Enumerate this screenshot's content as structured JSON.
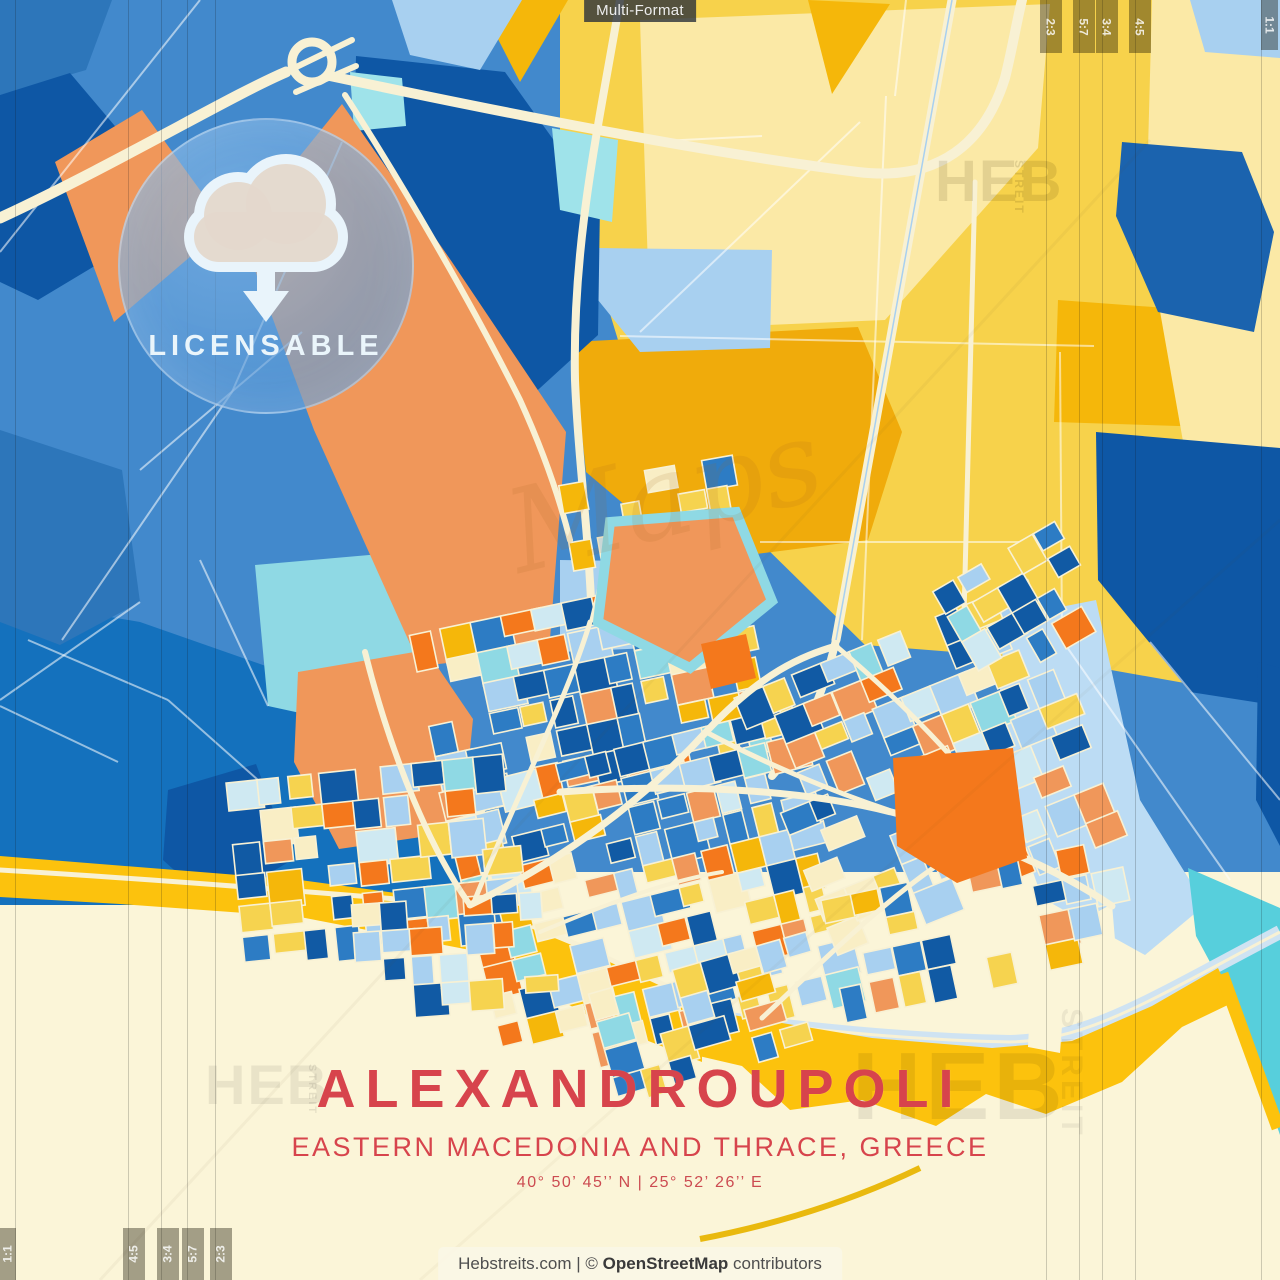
{
  "window": {
    "format_badge": "Multi-Format"
  },
  "license_badge": {
    "label": "LICENSABLE"
  },
  "title_block": {
    "city": "ALEXANDROUPOLI",
    "region": "EASTERN MACEDONIA AND THRACE, GREECE",
    "coordinates": "40°  50’  45’’ N   |   25°  52’  26’’ E"
  },
  "footer": {
    "site": "Hebstreits.com",
    "divider": " | ",
    "copyright": "© ",
    "source": "OpenStreetMap",
    "suffix": " contributors"
  },
  "crop_marks": {
    "top_right": [
      "2:3",
      "5:7",
      "3:4",
      "4:5",
      "1:1"
    ],
    "bottom_left": [
      "1:1",
      "4:5",
      "3:4",
      "5:7",
      "2:3"
    ]
  },
  "watermarks": {
    "brand": "HEB",
    "brand_side": "STREIT",
    "script": "Maps"
  },
  "map": {
    "palette": {
      "base_blue": "#4289cc",
      "blue_med": "#2d76ba",
      "blue_dark": "#0e57a5",
      "blue_navy": "#1b63ae",
      "sea_blue": "#1471bd",
      "blue_light": "#a8d0f0",
      "blue_pale": "#bcdcf4",
      "rail_blue": "#cfe3f2",
      "cyan": "#8fd9e4",
      "cyan_bright": "#9fe3ea",
      "turquoise": "#57cfdc",
      "salmon": "#f0975a",
      "orange": "#f4781c",
      "yellow": "#f7d24b",
      "amber": "#f0ab0b",
      "amber2": "#f5b70a",
      "yellow_pale": "#fbe9a6",
      "gold": "#fcc20d",
      "gold_road": "#e9b90e",
      "cream_road": "#f8f1d4",
      "cream_bg": "#fbf5d8",
      "title_red": "#d7444c"
    },
    "block_palette": [
      {
        "color": "#a8d0f0",
        "w": 0.18
      },
      {
        "color": "#cfe9f2",
        "w": 0.07
      },
      {
        "color": "#2d7cc4",
        "w": 0.12
      },
      {
        "color": "#115aa4",
        "w": 0.14
      },
      {
        "color": "#8fd9e4",
        "w": 0.04
      },
      {
        "color": "#f4781c",
        "w": 0.1
      },
      {
        "color": "#f0975a",
        "w": 0.08
      },
      {
        "color": "#f6d34f",
        "w": 0.15
      },
      {
        "color": "#f5b70a",
        "w": 0.04
      },
      {
        "color": "#f9eec5",
        "w": 0.08
      }
    ]
  }
}
